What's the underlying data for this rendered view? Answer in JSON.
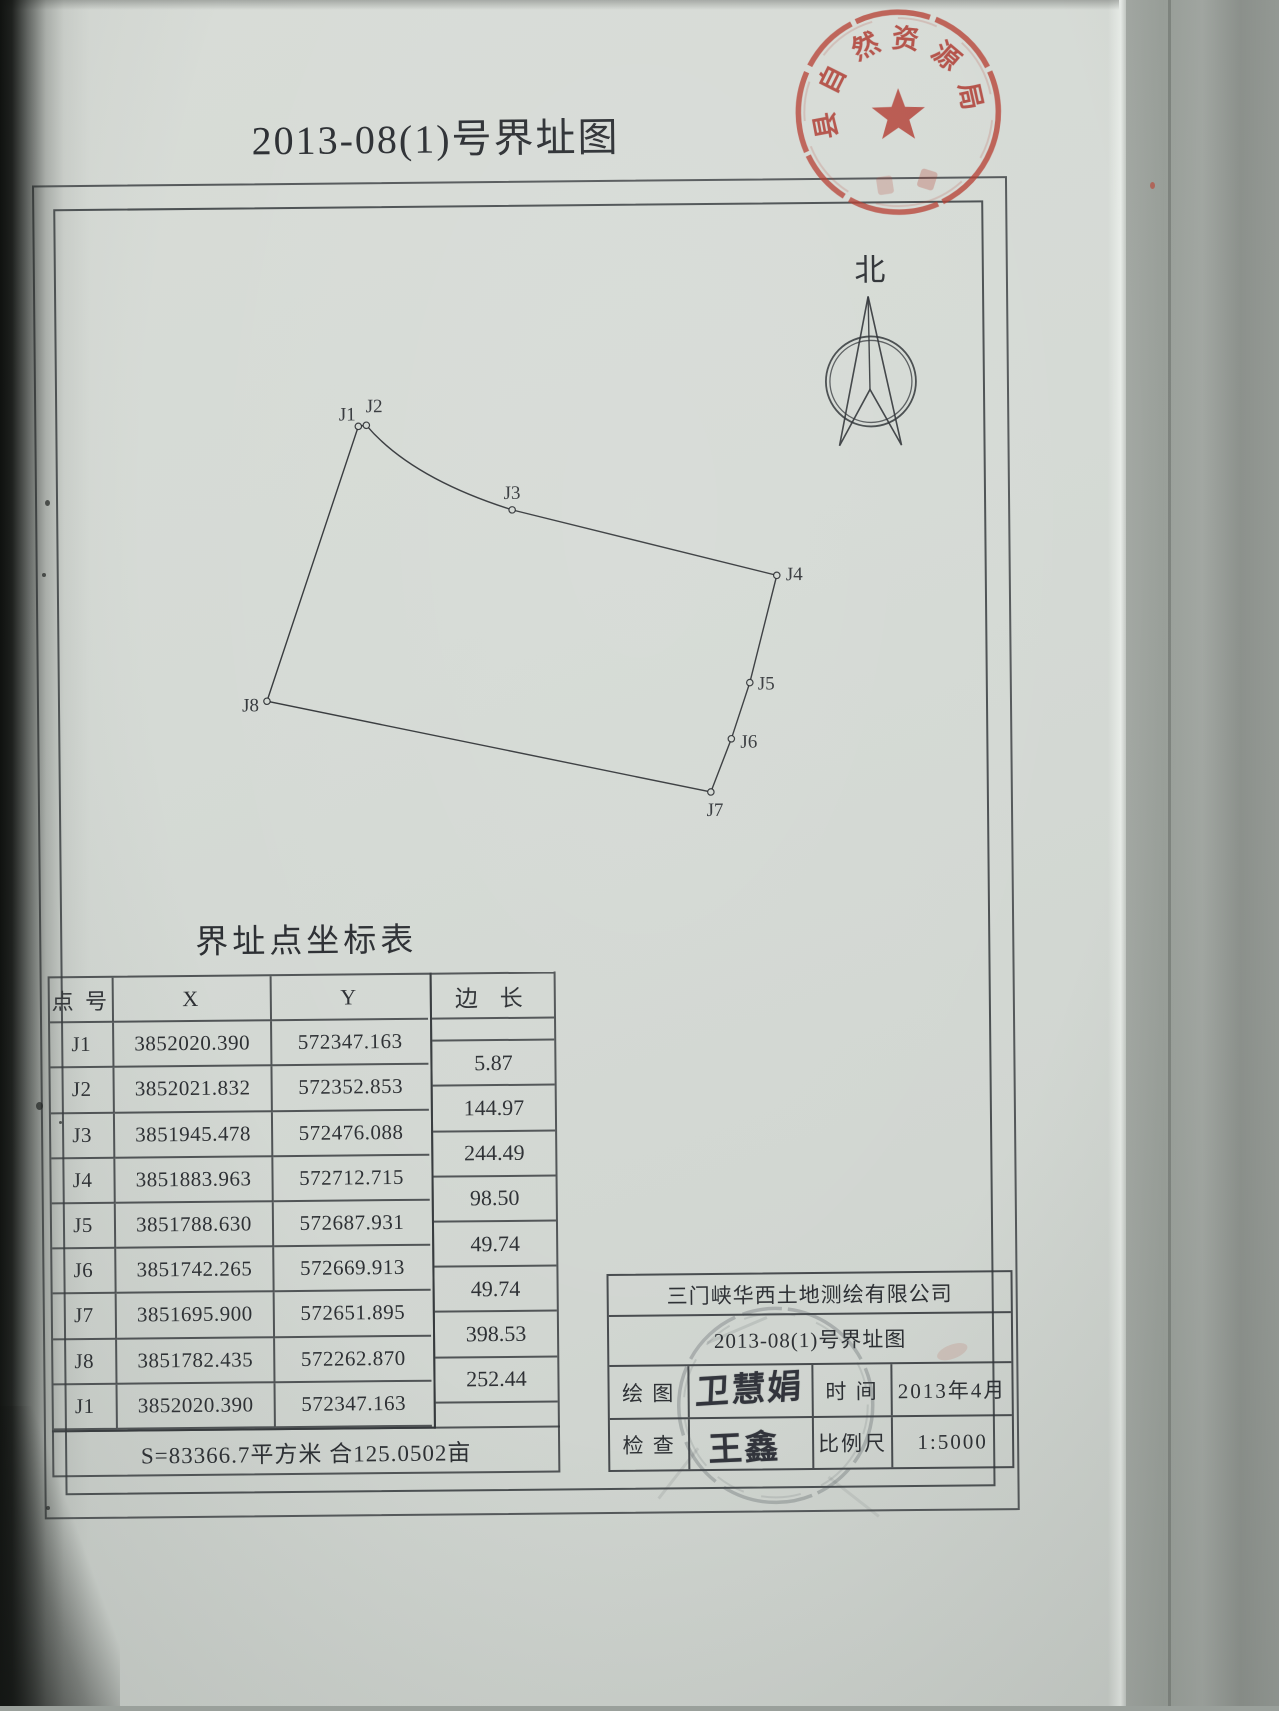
{
  "colors": {
    "paper": "#d4d9d4",
    "ink": "#33363a",
    "stamp_red": "#b5473b"
  },
  "header": {
    "title": "2013-08(1)号界址图"
  },
  "official_stamp": {
    "chars": [
      "县",
      "自",
      "然",
      "资",
      "源",
      "局"
    ]
  },
  "compass": {
    "north_label": "北"
  },
  "parcel_map": {
    "points": [
      {
        "label": "J1"
      },
      {
        "label": "J2"
      },
      {
        "label": "J3"
      },
      {
        "label": "J4"
      },
      {
        "label": "J5"
      },
      {
        "label": "J6"
      },
      {
        "label": "J7"
      },
      {
        "label": "J8"
      }
    ]
  },
  "coord_table": {
    "title": "界址点坐标表",
    "headers": {
      "point": "点 号",
      "x": "X",
      "y": "Y",
      "edge": "边 长"
    },
    "rows": [
      {
        "id": "J1",
        "x": "3852020.390",
        "y": "572347.163"
      },
      {
        "id": "J2",
        "x": "3852021.832",
        "y": "572352.853"
      },
      {
        "id": "J3",
        "x": "3851945.478",
        "y": "572476.088"
      },
      {
        "id": "J4",
        "x": "3851883.963",
        "y": "572712.715"
      },
      {
        "id": "J5",
        "x": "3851788.630",
        "y": "572687.931"
      },
      {
        "id": "J6",
        "x": "3851742.265",
        "y": "572669.913"
      },
      {
        "id": "J7",
        "x": "3851695.900",
        "y": "572651.895"
      },
      {
        "id": "J8",
        "x": "3851782.435",
        "y": "572262.870"
      },
      {
        "id": "J1",
        "x": "3852020.390",
        "y": "572347.163"
      }
    ],
    "edges": [
      "5.87",
      "144.97",
      "244.49",
      "98.50",
      "49.74",
      "49.74",
      "398.53",
      "252.44"
    ],
    "footer": "S=83366.7平方米 合125.0502亩"
  },
  "title_block": {
    "company": "三门峡华西土地测绘有限公司",
    "sheet_title": "2013-08(1)号界址图",
    "labels": {
      "draw": "绘 图",
      "time": "时 间",
      "check": "检 查",
      "scale": "比例尺"
    },
    "values": {
      "time": "2013年4月",
      "scale": "1:5000"
    },
    "signatures": {
      "draw": "卫慧娟",
      "check": "王鑫"
    }
  }
}
